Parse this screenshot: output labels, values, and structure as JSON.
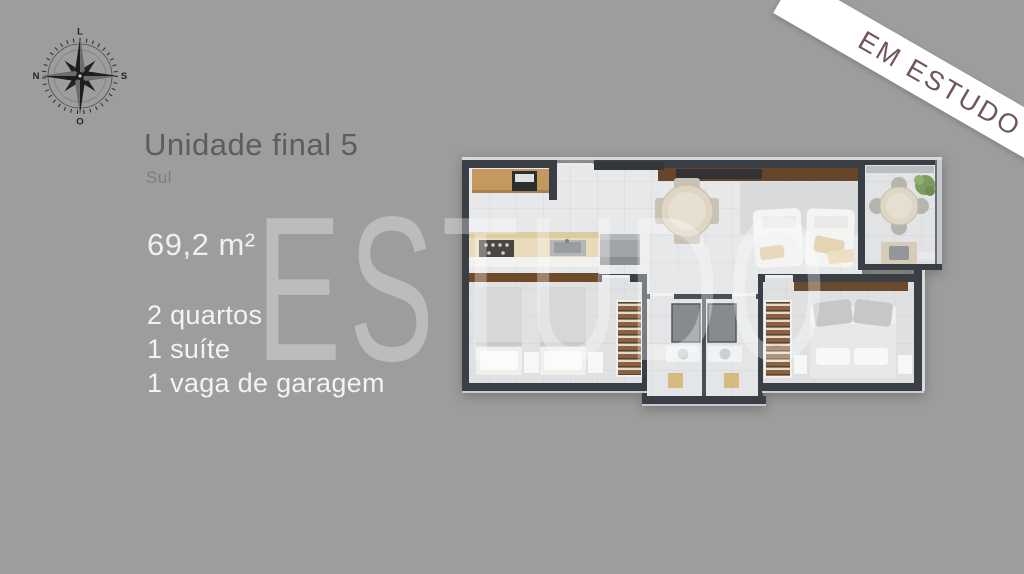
{
  "slide": {
    "background_color": "#9e9d9d",
    "type": "floor-plan-presentation"
  },
  "ribbon": {
    "label": "EM ESTUDO",
    "background_color": "#ffffff",
    "text_color": "#6f5659"
  },
  "compass": {
    "top": "L",
    "right": "S",
    "bottom": "O",
    "left": "N"
  },
  "unit": {
    "title": "Unidade final 5",
    "orientation": "Sul",
    "area": "69,2 m²",
    "features": [
      "2 quartos",
      "1 suíte",
      "1 vaga de garagem"
    ]
  },
  "watermark": {
    "text": "ESTUDO"
  },
  "floorplan_colors": {
    "wall": "#3a3f45",
    "floor": "#e7e8ea",
    "wood": "#6a4a2d",
    "counter_wood": "#c49960",
    "plant": "#7d9b5e",
    "mat": "#d7ba82"
  }
}
